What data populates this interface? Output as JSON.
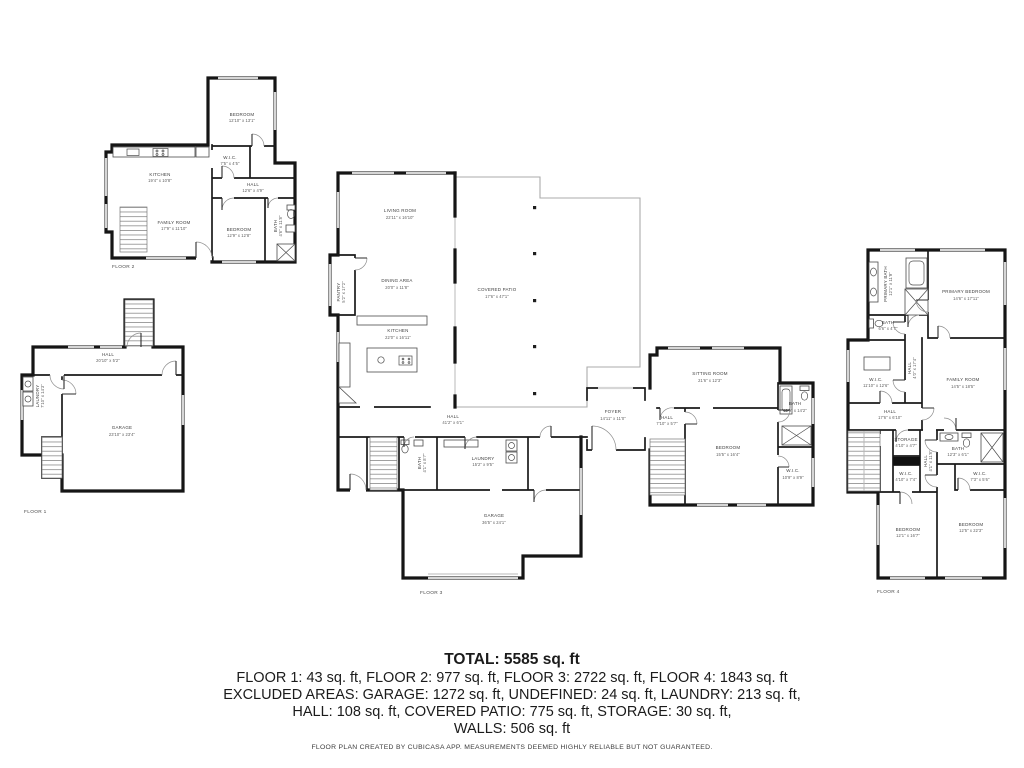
{
  "palette": {
    "wall": "#151515",
    "window": "#d6d6d6",
    "label": "#3f3f3f",
    "background": "#ffffff"
  },
  "summary": {
    "total": "TOTAL: 5585 sq. ft",
    "floors_line": "FLOOR 1: 43 sq. ft, FLOOR 2: 977 sq. ft, FLOOR 3: 2722 sq. ft, FLOOR 4: 1843 sq. ft",
    "excluded_line1": "EXCLUDED AREAS: GARAGE: 1272 sq. ft, UNDEFINED: 24 sq. ft, LAUNDRY: 213 sq. ft,",
    "excluded_line2": "HALL: 108 sq. ft, COVERED PATIO: 775 sq. ft, STORAGE: 30 sq. ft,",
    "excluded_line3": "WALLS: 506 sq. ft",
    "disclaimer": "FLOOR PLAN CREATED BY CUBICASA APP. MEASUREMENTS DEEMED HIGHLY RELIABLE BUT NOT GUARANTEED."
  },
  "floor1": {
    "label": "FLOOR 1",
    "rooms": {
      "hall": {
        "name": "HALL",
        "dims": "20'10\" x 5'2\""
      },
      "laundry": {
        "name": "LAUNDRY",
        "dims": "7'10\" x 14'3\""
      },
      "garage": {
        "name": "GARAGE",
        "dims": "23'10\" x 23'4\""
      }
    }
  },
  "floor2": {
    "label": "FLOOR 2",
    "rooms": {
      "bedroom1": {
        "name": "BEDROOM",
        "dims": "12'10\" x 13'1\""
      },
      "wic": {
        "name": "W.I.C.",
        "dims": "7'5\" x 4'5\""
      },
      "hall": {
        "name": "HALL",
        "dims": "12'6\" x 4'9\""
      },
      "kitchen": {
        "name": "KITCHEN",
        "dims": "19'4\" x 10'8\""
      },
      "family_room": {
        "name": "FAMILY ROOM",
        "dims": "17'9\" x 11'10\""
      },
      "bedroom2": {
        "name": "BEDROOM",
        "dims": "12'9\" x 12'8\""
      },
      "bath": {
        "name": "BATH",
        "dims": "4'6\" x 11'8\""
      }
    }
  },
  "floor3": {
    "label": "FLOOR 3",
    "rooms": {
      "living_room": {
        "name": "LIVING ROOM",
        "dims": "22'11\" x 16'10\""
      },
      "dining_area": {
        "name": "DINING AREA",
        "dims": "20'0\" x 11'8\""
      },
      "pantry": {
        "name": "PANTRY",
        "dims": "5'2\" x 17'2\""
      },
      "kitchen": {
        "name": "KITCHEN",
        "dims": "22'0\" x 16'11\""
      },
      "covered_patio": {
        "name": "COVERED PATIO",
        "dims": "17'6\" x 47'1\""
      },
      "hall": {
        "name": "HALL",
        "dims": "41'2\" x 6'1\""
      },
      "bath": {
        "name": "BATH",
        "dims": "4'1\" x 8'7\""
      },
      "laundry": {
        "name": "LAUNDRY",
        "dims": "15'2\" x 9'5\""
      },
      "garage": {
        "name": "GARAGE",
        "dims": "36'5\" x 24'1\""
      },
      "foyer": {
        "name": "FOYER",
        "dims": "14'11\" x 11'0\""
      },
      "hall2": {
        "name": "HALL",
        "dims": "7'10\" x 5'7\""
      },
      "sitting_room": {
        "name": "SITTING ROOM",
        "dims": "21'6\" x 12'3\""
      },
      "bedroom": {
        "name": "BEDROOM",
        "dims": "15'5\" x 16'4\""
      },
      "bath2": {
        "name": "BATH",
        "dims": "10'9\" x 14'2\""
      },
      "wic": {
        "name": "W.I.C.",
        "dims": "10'9\" x 8'9\""
      }
    }
  },
  "floor4": {
    "label": "FLOOR 4",
    "rooms": {
      "primary_bath": {
        "name": "PRIMARY BATH",
        "dims": "12'1\" x 11'9\""
      },
      "primary_bedroom": {
        "name": "PRIMARY BEDROOM",
        "dims": "14'6\" x 17'11\""
      },
      "bath1": {
        "name": "BATH",
        "dims": "6'6\" x 4'7\""
      },
      "wic1": {
        "name": "W.I.C.",
        "dims": "11'10\" x 12'6\""
      },
      "hall_upper": {
        "name": "HALL",
        "dims": "4'0\" x 17'4\""
      },
      "family_room": {
        "name": "FAMILY ROOM",
        "dims": "14'5\" x 18'5\""
      },
      "hall": {
        "name": "HALL",
        "dims": "17'6\" x 6'10\""
      },
      "storage": {
        "name": "STORAGE",
        "dims": "4'10\" x 4'7\""
      },
      "hall_lower": {
        "name": "HALL",
        "dims": "4'1\" x 11'8\""
      },
      "bath2": {
        "name": "BATH",
        "dims": "12'3\" x 6'1\""
      },
      "wic2": {
        "name": "W.I.C.",
        "dims": "4'10\" x 7'4\""
      },
      "wic3": {
        "name": "W.I.C.",
        "dims": "7'3\" x 5'6\""
      },
      "bedroom1": {
        "name": "BEDROOM",
        "dims": "12'1\" x 16'7\""
      },
      "bedroom2": {
        "name": "BEDROOM",
        "dims": "12'5\" x 22'3\""
      }
    }
  }
}
